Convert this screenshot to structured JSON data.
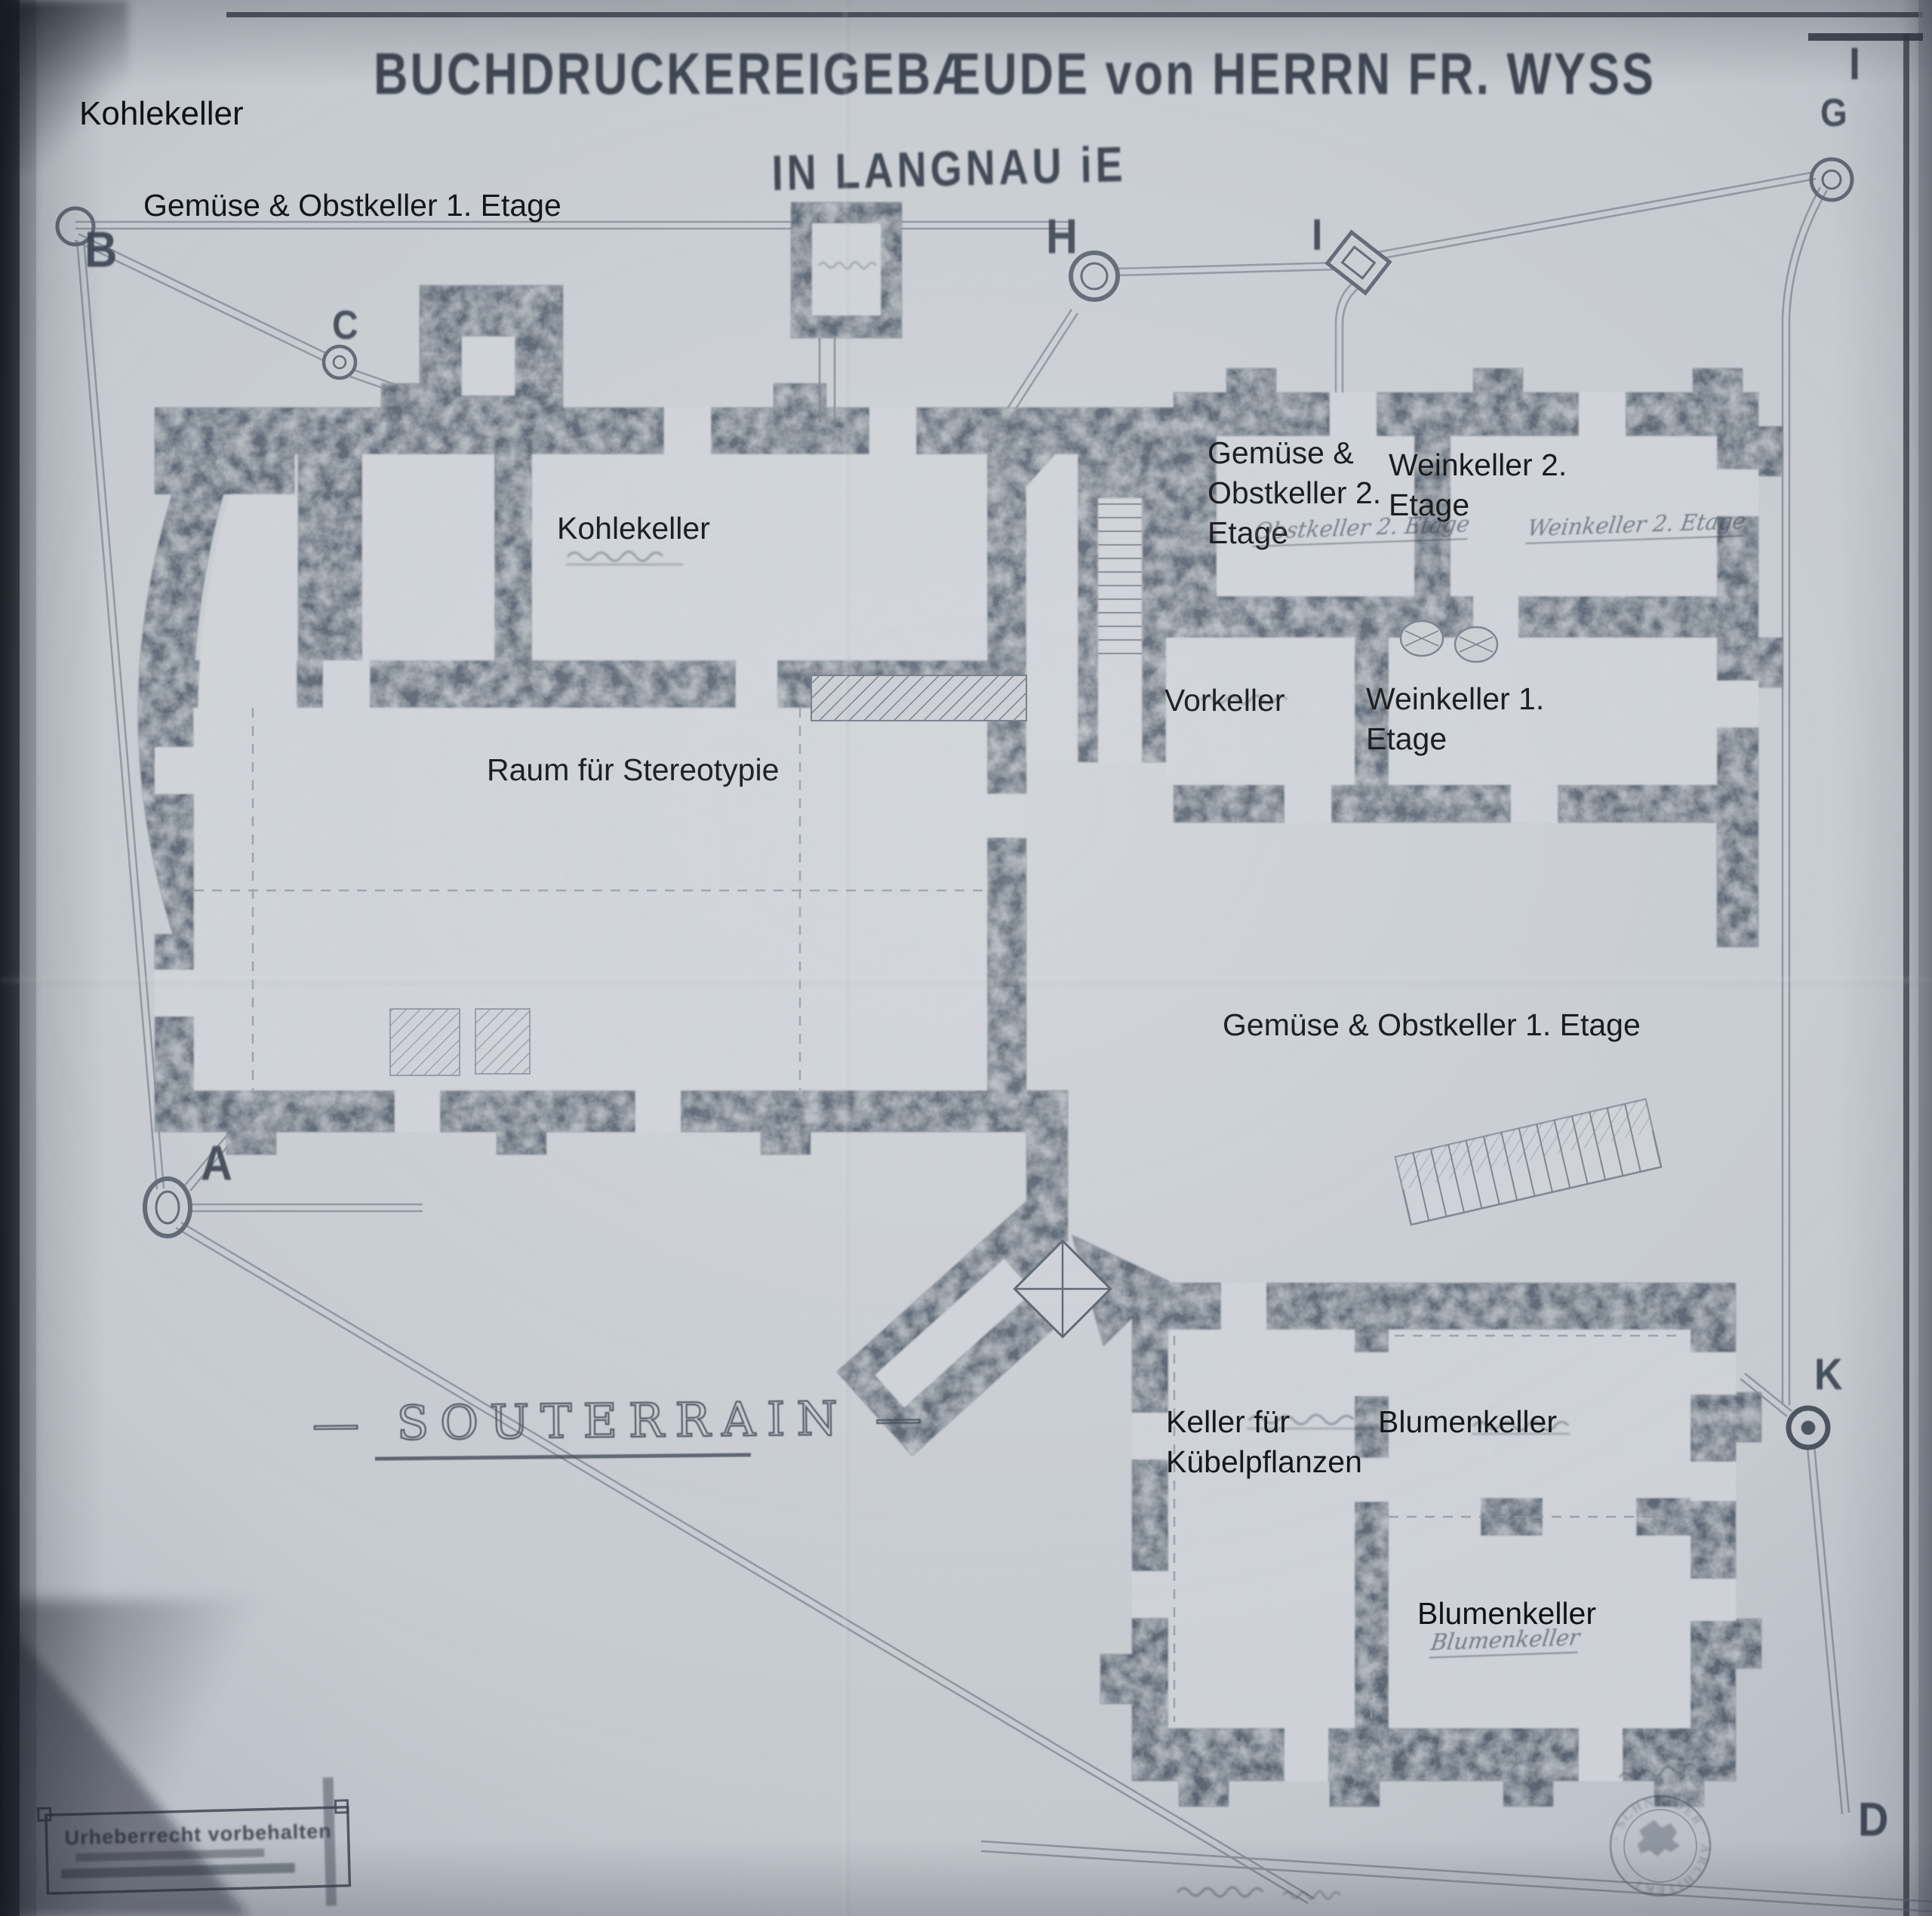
{
  "document": {
    "title_line1": "BUCHDRUCKEREIGEBÆUDE von HERRN FR. WYSS",
    "title_line2": "IN LANGNAU iE",
    "floor_label_decorated": "— SOUTERRAIN —",
    "floor_label": "SOUTERRAIN"
  },
  "overlay_labels": [
    {
      "id": "kohlekeller-corner",
      "text": "Kohlekeller"
    },
    {
      "id": "gemuese-obstkeller-1-top",
      "text": "Gemüse & Obstkeller 1. Etage"
    },
    {
      "id": "kohlekeller-room",
      "text": "Kohlekeller"
    },
    {
      "id": "raum-fuer-stereotypie",
      "text": "Raum für Stereotypie"
    },
    {
      "id": "gemuese-obstkeller-2",
      "text": "Gemüse &\nObstkeller 2.\nEtage"
    },
    {
      "id": "weinkeller-2",
      "text": "Weinkeller 2.\nEtage"
    },
    {
      "id": "vorkeller",
      "text": "Vorkeller"
    },
    {
      "id": "weinkeller-1",
      "text": "Weinkeller 1.\nEtage"
    },
    {
      "id": "gemuese-obstkeller-1-mid",
      "text": "Gemüse & Obstkeller 1. Etage"
    },
    {
      "id": "keller-fuer-kuebelpflanzen",
      "text": "Keller für\nKübelpflanzen"
    },
    {
      "id": "blumenkeller-top",
      "text": "Blumenkeller"
    },
    {
      "id": "blumenkeller-bottom",
      "text": "Blumenkeller"
    }
  ],
  "plan_letters": [
    {
      "char": "B"
    },
    {
      "char": "C"
    },
    {
      "char": "G"
    },
    {
      "char": "I"
    },
    {
      "char": "H"
    },
    {
      "char": "I"
    },
    {
      "char": "A"
    },
    {
      "char": "K"
    },
    {
      "char": "D"
    }
  ],
  "handwritten_annotations": [
    {
      "id": "obstkeller-2-cursive",
      "text": "Obstkeller 2. Etage"
    },
    {
      "id": "weinkeller-2-cursive",
      "text": "Weinkeller 2. Etage"
    },
    {
      "id": "blumenkeller-cursive",
      "text": "Blumenkeller"
    }
  ],
  "stamps": {
    "copyright_line1": "Urheberrecht vorbehalten",
    "seal_text": "· SCHNEIDER · ARCHITEKT ·"
  }
}
